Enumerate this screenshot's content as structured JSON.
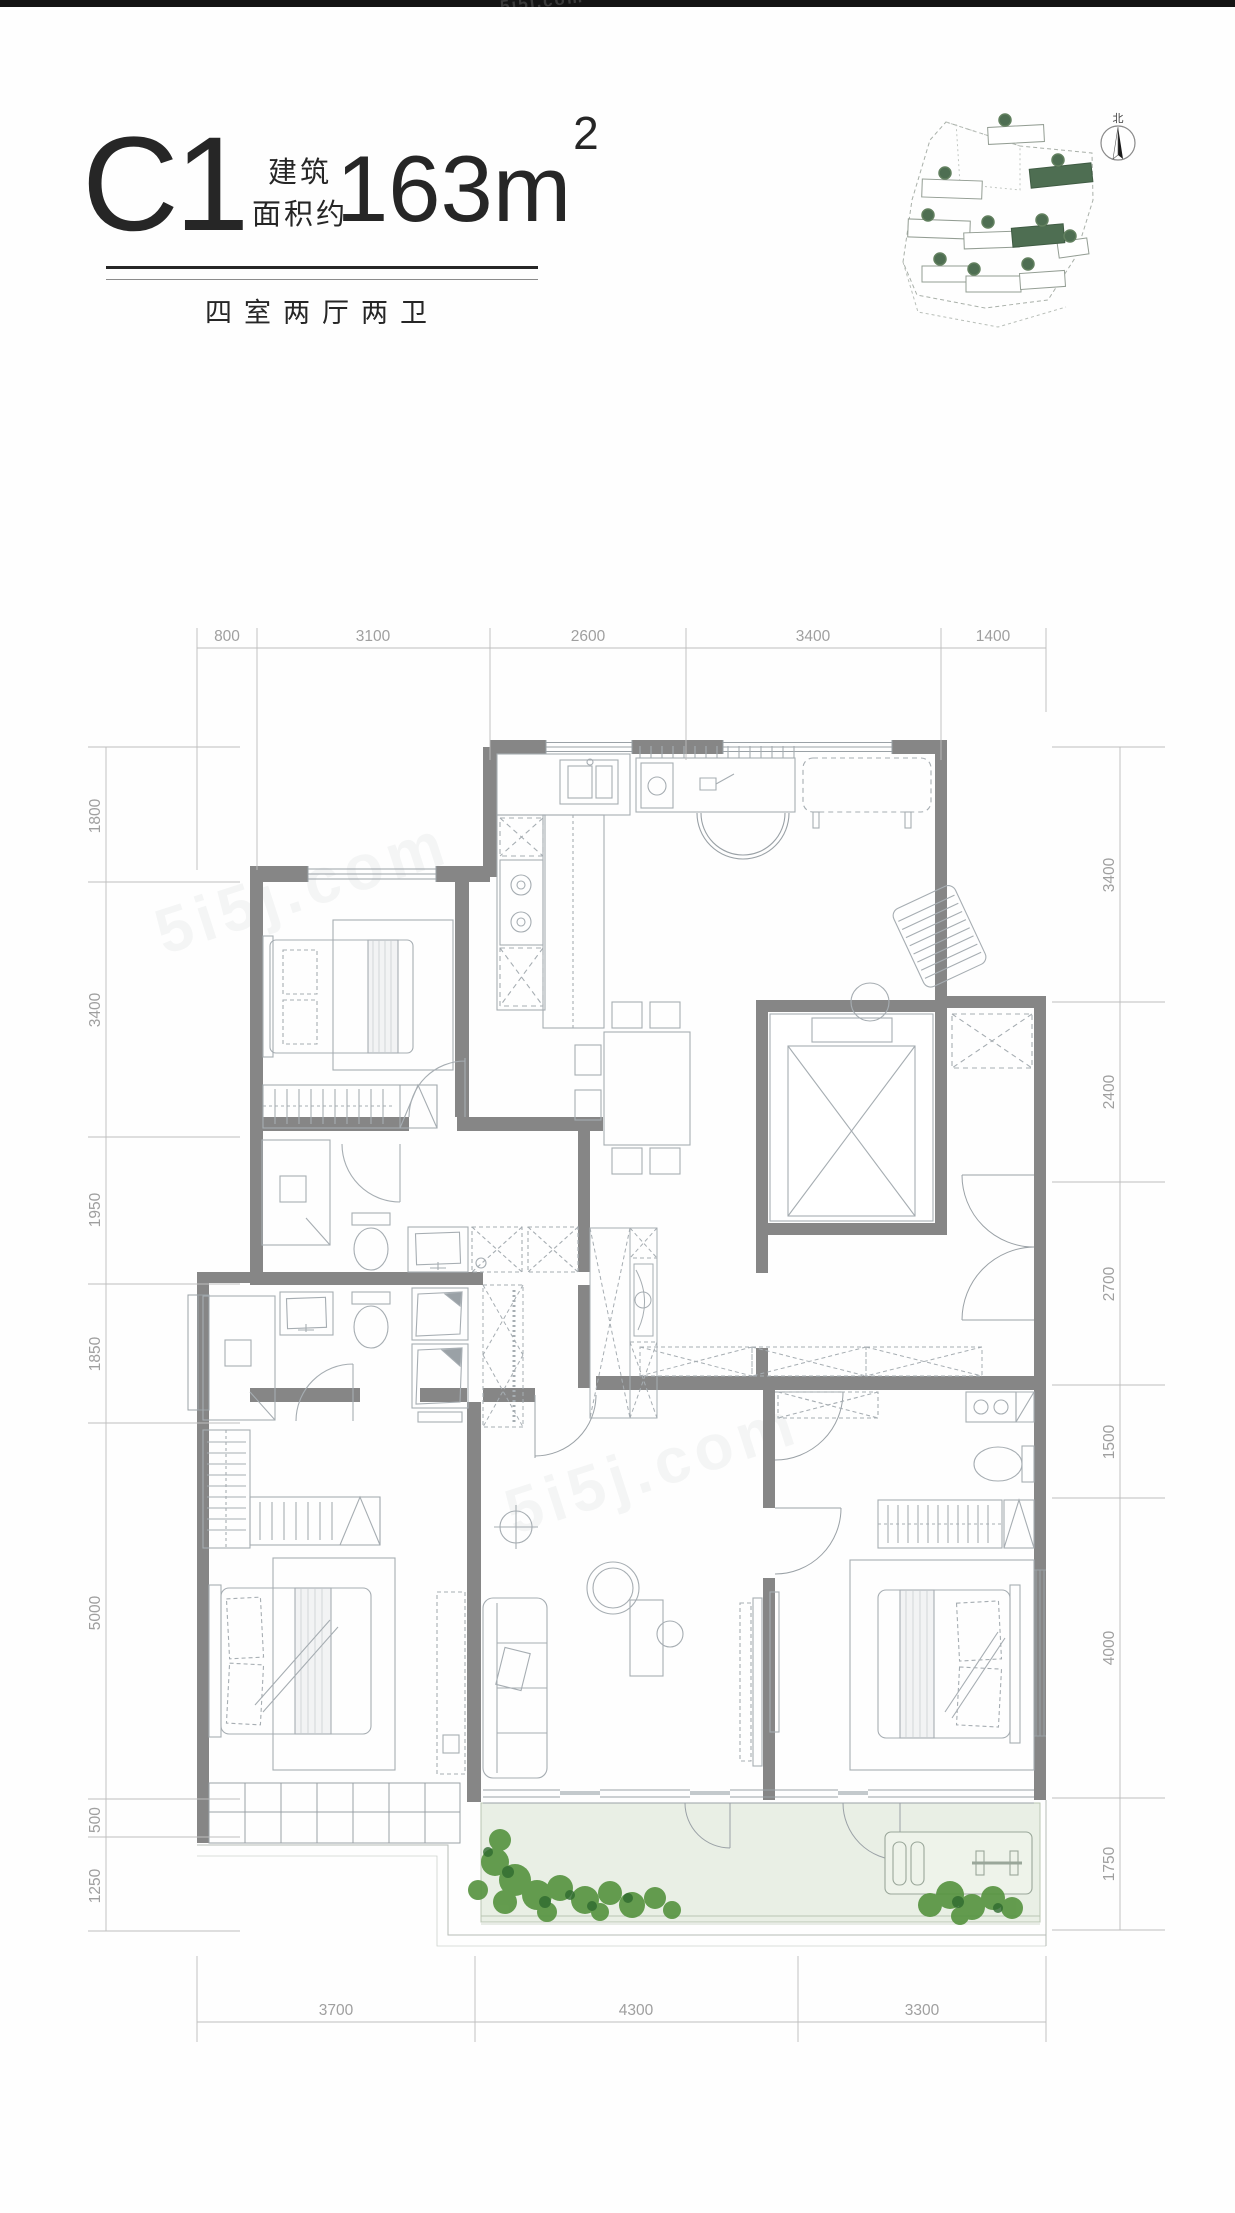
{
  "watermark": {
    "text": "5i5j.com"
  },
  "header": {
    "plan_code": "C1",
    "area_prefix_line1": "建筑",
    "area_prefix_line2": "面积约",
    "area_value": "163m",
    "area_superscript": "2",
    "layout_label": "四室两厅两卫"
  },
  "site_plan": {
    "north_label": "北"
  },
  "dims": {
    "top": [
      "800",
      "3100",
      "2600",
      "3400",
      "1400"
    ],
    "bottom": [
      "3700",
      "4300",
      "3300"
    ],
    "left": [
      "1800",
      "3400",
      "1950",
      "1850",
      "5000",
      "500",
      "1250"
    ],
    "right": [
      "3400",
      "2400",
      "2700",
      "1500",
      "4000",
      "1750"
    ]
  },
  "colors": {
    "wall": "#868686",
    "furniture_line": "#a6adb2",
    "dimension_text": "#9f9f9f",
    "balcony_fill": "#e9efe5",
    "plant_green": "#55923e",
    "site_highlight_green": "#4e6e52",
    "title_ink": "#262626",
    "topbar_black": "#141414"
  }
}
